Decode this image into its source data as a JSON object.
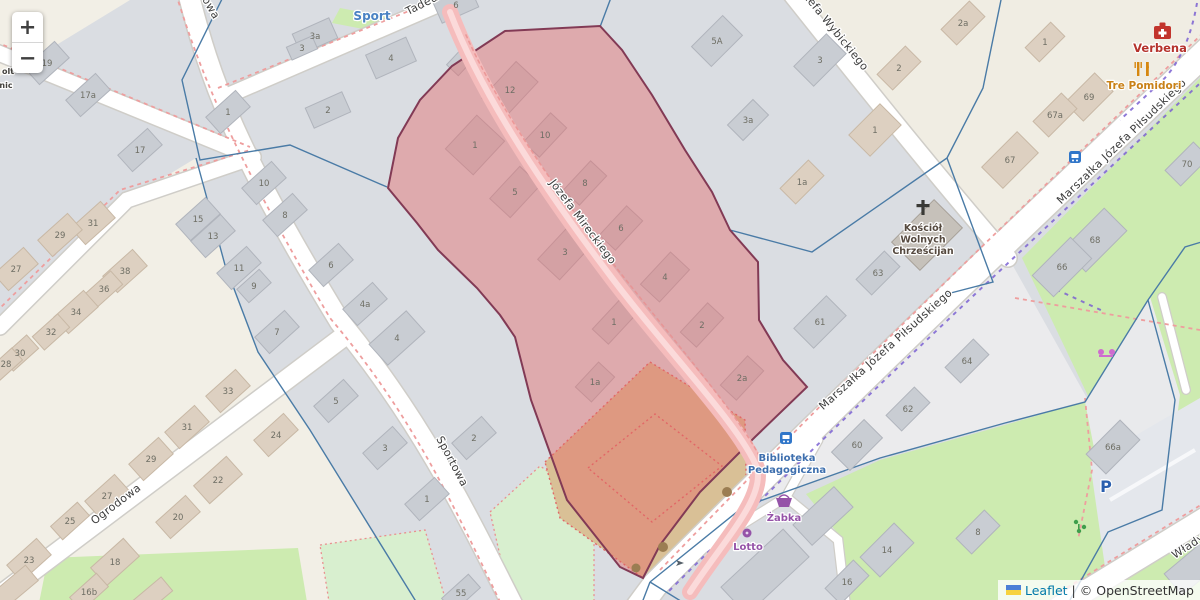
{
  "attribution": {
    "leaflet_label": "Leaflet",
    "divider": "|",
    "osm_label": "© OpenStreetMap",
    "flag_top_color": "#4c7fd6",
    "flag_bottom_color": "#f7d23e"
  },
  "zoom_control": {
    "zoom_in_label": "+",
    "zoom_out_label": "−"
  },
  "selection": {
    "fill": "rgba(228,100,100,0.42)",
    "stroke": "#823a55"
  },
  "colors": {
    "base": "#dadde2",
    "cream": "#f2efe6",
    "white_block": "#ebebed",
    "green": "#cdebb0",
    "mint": "#d8efcf",
    "tan": "#d9c096",
    "street_fill": "#ffffff",
    "street_casing": "#cfcdc8",
    "pink_street": "#f5bcbc",
    "pink_core": "#fbdada",
    "boundary_blue": "#4a7ba6",
    "sidewalk_red": "#ee9e9e",
    "cycle_purple": "#7b61d2",
    "bld_gray": "#c9cdd3",
    "bld_gray_stroke": "#b0b4bc",
    "bld_beige": "#ddd0c1",
    "bld_beige_stroke": "#c8b8a5",
    "bld_dark": "#c6c1ba",
    "bld_dark_stroke": "#a8a199",
    "house_number": "#6e6e64",
    "street_label": "#3c3c3c"
  },
  "streets": [
    {
      "name": "Sportowa",
      "labels": [
        {
          "x": 449,
          "y": 463,
          "rot": 62
        },
        {
          "x": 200,
          "y": -4,
          "rot": 60
        }
      ]
    },
    {
      "name": "Ogrodowa",
      "labels": [
        {
          "x": 118,
          "y": 507,
          "rot": -37
        }
      ]
    },
    {
      "name": "Tadeusza",
      "labels": [
        {
          "x": 432,
          "y": 3,
          "rot": -27
        }
      ]
    },
    {
      "name": "Józefa Mireckiego",
      "labels": [
        {
          "x": 580,
          "y": 224,
          "rot": 53
        }
      ]
    },
    {
      "name": "Józefa Wybickiego",
      "labels": [
        {
          "x": 830,
          "y": 30,
          "rot": 51
        }
      ]
    },
    {
      "name": "Marszałka Józefa Piłsudskiego",
      "labels": [
        {
          "x": 1124,
          "y": 144,
          "rot": -44
        },
        {
          "x": 888,
          "y": 352,
          "rot": -42
        }
      ]
    },
    {
      "name": "Władysława",
      "labels": [
        {
          "x": 1204,
          "y": 540,
          "rot": -33
        }
      ]
    }
  ],
  "pois": [
    {
      "id": "sport",
      "lines": [
        "Sport"
      ],
      "x": 372,
      "y": 20,
      "color": "#4a82c3",
      "size": 12
    },
    {
      "id": "verbena",
      "lines": [
        "Verbena"
      ],
      "x": 1160,
      "y": 52,
      "color": "#b5332c",
      "size": 11.5
    },
    {
      "id": "tre-pomidori",
      "lines": [
        "Tre Pomidori"
      ],
      "x": 1144,
      "y": 89,
      "color": "#c98117",
      "size": 10.5
    },
    {
      "id": "church",
      "lines": [
        "Kościół",
        "Wolnych",
        "Chrześcijan"
      ],
      "x": 923,
      "y": 231,
      "color": "#55493f",
      "size": 9.5
    },
    {
      "id": "biblioteka",
      "lines": [
        "Biblioteka",
        "Pedagogiczna"
      ],
      "x": 787,
      "y": 461,
      "color": "#3e6fae",
      "size": 10
    },
    {
      "id": "zabka",
      "lines": [
        "Żabka"
      ],
      "x": 784,
      "y": 521,
      "color": "#9553a8",
      "size": 10
    },
    {
      "id": "lotto",
      "lines": [
        "Lotto"
      ],
      "x": 748,
      "y": 550,
      "color": "#9553a8",
      "size": 10
    },
    {
      "id": "parking",
      "lines": [
        "P"
      ],
      "x": 1106,
      "y": 492,
      "color": "#2a5fae",
      "size": 16
    },
    {
      "id": "poi-fragment-1",
      "lines": [
        "olt"
      ],
      "x": 8,
      "y": 74,
      "color": "#44423e",
      "size": 8
    },
    {
      "id": "poi-fragment-2",
      "lines": [
        "nic"
      ],
      "x": 6,
      "y": 88,
      "color": "#44423e",
      "size": 8
    }
  ],
  "house_numbers": [
    [
      "17a",
      88,
      95,
      "g"
    ],
    [
      "17",
      140,
      150,
      "g"
    ],
    [
      "19",
      47,
      63,
      "g"
    ],
    [
      "1",
      228,
      112,
      "g"
    ],
    [
      "10",
      264,
      183,
      "g"
    ],
    [
      "8",
      285,
      215,
      "g"
    ],
    [
      "6",
      331,
      265,
      "g"
    ],
    [
      "4a",
      365,
      304,
      "g"
    ],
    [
      "4",
      397,
      338,
      "g",
      -42,
      50,
      28
    ],
    [
      "15",
      198,
      219,
      "g"
    ],
    [
      "13",
      213,
      236,
      "g"
    ],
    [
      "11",
      239,
      268,
      "g"
    ],
    [
      "9",
      254,
      286,
      "g",
      -42,
      30,
      18
    ],
    [
      "7",
      277,
      332,
      "g"
    ],
    [
      "5",
      336,
      401,
      "g"
    ],
    [
      "3",
      385,
      448,
      "g"
    ],
    [
      "1",
      427,
      499,
      "g"
    ],
    [
      "2",
      474,
      438,
      "g"
    ],
    [
      "55",
      461,
      593,
      "g",
      -42,
      36,
      18
    ],
    [
      "31",
      93,
      223,
      "b"
    ],
    [
      "29",
      60,
      235,
      "b"
    ],
    [
      "27",
      16,
      269,
      "b"
    ],
    [
      "38",
      125,
      271,
      "b"
    ],
    [
      "36",
      104,
      289,
      "b",
      -42,
      34,
      18
    ],
    [
      "34",
      76,
      312,
      "b"
    ],
    [
      "32",
      51,
      332,
      "b",
      -42,
      34,
      18
    ],
    [
      "30",
      20,
      353,
      "b",
      -42,
      34,
      18
    ],
    [
      "28",
      6,
      364,
      "b",
      -42,
      30,
      16
    ],
    [
      "33",
      228,
      391,
      "b"
    ],
    [
      "31",
      187,
      427,
      "b"
    ],
    [
      "29",
      151,
      459,
      "b"
    ],
    [
      "27",
      107,
      496,
      "b"
    ],
    [
      "25",
      70,
      521,
      "b",
      -42,
      36,
      18
    ],
    [
      "23",
      29,
      560,
      "b"
    ],
    [
      "24",
      276,
      435,
      "b"
    ],
    [
      "22",
      218,
      480,
      "b",
      -42,
      44,
      24
    ],
    [
      "20",
      178,
      517,
      "b"
    ],
    [
      "18",
      115,
      562,
      "b",
      -42,
      44,
      24
    ],
    [
      "16b",
      89,
      592,
      "b",
      -42,
      36,
      18
    ],
    [
      "3a",
      315,
      36,
      "g",
      -24
    ],
    [
      "3",
      302,
      48,
      "g",
      -24,
      28,
      14
    ],
    [
      "4",
      391,
      58,
      "g",
      -24,
      44,
      26
    ],
    [
      "2",
      328,
      110,
      "g",
      -24
    ],
    [
      "6",
      456,
      5,
      "g",
      -24
    ],
    [
      "12",
      510,
      90,
      "g",
      -47,
      50,
      30
    ],
    [
      "10",
      545,
      135,
      "g",
      -47
    ],
    [
      "8",
      585,
      183,
      "g",
      -47
    ],
    [
      "1",
      475,
      145,
      "g",
      -47,
      46,
      38
    ],
    [
      "5",
      515,
      192,
      "g",
      -47,
      44,
      28
    ],
    [
      "6",
      621,
      228,
      "g",
      -47
    ],
    [
      "3",
      565,
      252,
      "g",
      -47,
      48,
      30
    ],
    [
      "4",
      665,
      277,
      "g",
      -47,
      44,
      26
    ],
    [
      "1",
      614,
      322,
      "g",
      -47
    ],
    [
      "2",
      702,
      325,
      "g",
      -47
    ],
    [
      "1a",
      595,
      382,
      "g",
      -47,
      34,
      22
    ],
    [
      "2a",
      742,
      378,
      "g",
      -47
    ],
    [
      "5A",
      717,
      41,
      "g",
      -45,
      44,
      28
    ],
    [
      "3",
      820,
      60,
      "g",
      -45,
      46,
      28
    ],
    [
      "3a",
      748,
      120,
      "g",
      -45,
      36,
      22
    ],
    [
      "2",
      899,
      68,
      "b",
      -45
    ],
    [
      "1",
      875,
      130,
      "b",
      -45,
      44,
      30
    ],
    [
      "1a",
      802,
      182,
      "b",
      -45
    ],
    [
      "2a",
      963,
      23,
      "b",
      -45
    ],
    [
      "1",
      1045,
      42,
      "b",
      -45,
      36,
      20
    ],
    [
      "69",
      1089,
      97,
      "b",
      -45,
      42,
      26
    ],
    [
      "67a",
      1055,
      115,
      "b",
      -45
    ],
    [
      "67",
      1010,
      160,
      "b",
      -45,
      50,
      30
    ],
    [
      "70",
      1187,
      164,
      "g",
      -45
    ],
    [
      "63",
      878,
      273,
      "g",
      -45
    ],
    [
      "61",
      820,
      322,
      "g",
      -45,
      46,
      28
    ],
    [
      "68",
      1095,
      240,
      "g",
      -45,
      58,
      32
    ],
    [
      "66",
      1062,
      267,
      "g",
      -45,
      54,
      30
    ],
    [
      "64",
      967,
      361,
      "g",
      -45
    ],
    [
      "62",
      908,
      409,
      "g",
      -45
    ],
    [
      "60",
      857,
      445,
      "g",
      -45,
      46,
      26
    ],
    [
      "66a",
      1113,
      447,
      "g",
      -45,
      48,
      28
    ],
    [
      "14",
      887,
      550,
      "g",
      -45,
      48,
      28
    ],
    [
      "16",
      847,
      582,
      "g",
      -45
    ],
    [
      "8",
      978,
      532,
      "g",
      -45
    ]
  ]
}
